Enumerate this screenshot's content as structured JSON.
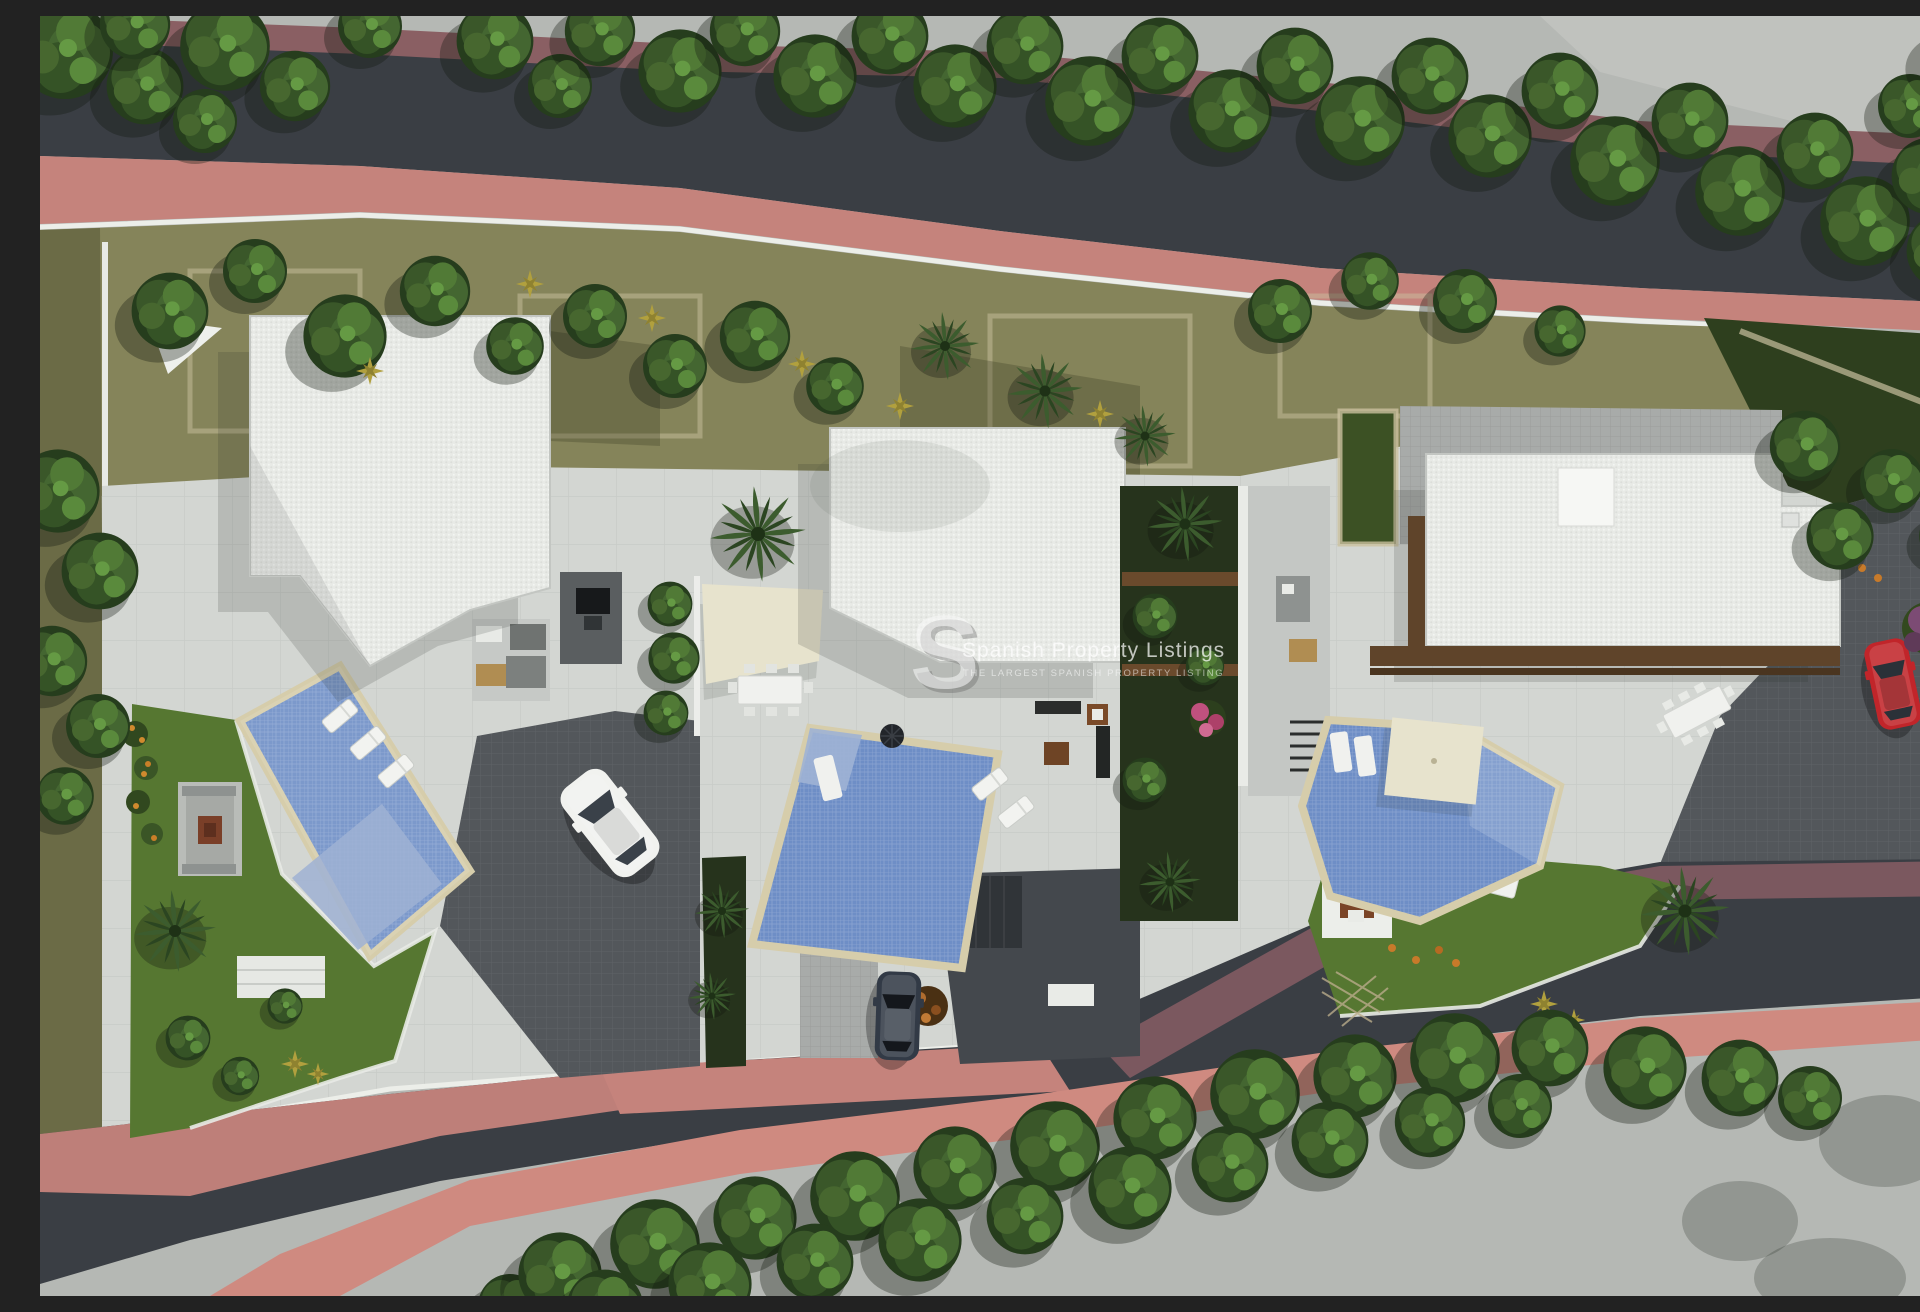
{
  "watermark": {
    "logo_letter": "S",
    "title": "Spanish Property Listings",
    "tagline": "THE LARGEST SPANISH PROPERTY LISTING"
  },
  "scene": {
    "type": "aerial-architectural-render",
    "description": "Top-down 3D visualisation of a hillside development plot with three modern villas, each with private pool, terraces, gardens and parking, wrapped by a curving dark asphalt road with terracotta-pink sidewalks lined with trees.",
    "villas": [
      {
        "name": "left-villa",
        "roof": "flat white gravel roof",
        "pool": "angled rectangular pool with end steps",
        "vehicles": [
          "white car on paver driveway"
        ],
        "features": [
          "three sun loungers",
          "outdoor sofa lounge",
          "sunken fire-pit lounge",
          "lawn with citrus shrubs",
          "corner shade sail"
        ]
      },
      {
        "name": "middle-villa",
        "roof": "flat white gravel roof",
        "pool": "skewed rectangular pool with swim-out lounger",
        "vehicles": [
          "dark saloon in drive"
        ],
        "features": [
          "cream shade sail",
          "outdoor dining table",
          "dark patio umbrella",
          "sun loungers",
          "palm garden strips",
          "lower dark courtyard"
        ]
      },
      {
        "name": "right-villa",
        "roof": "flat white roof with timber deck edge",
        "pool": "angular pool with in-water loungers",
        "vehicles": [
          "red car on side drive"
        ],
        "features": [
          "cream parasol",
          "long dining table",
          "fire-pit lounge on lawn",
          "paved entry courtyard",
          "planted corridor with stairs"
        ]
      }
    ],
    "environment": {
      "road": "dark asphalt loop",
      "sidewalks": "terracotta pink",
      "tree_rows": [
        "dense tree line along top road edge",
        "hedge row along lower road"
      ],
      "ground": "olive scrub terrace band above the plots"
    }
  },
  "palette": {
    "asphalt": "#3a3e44",
    "sidewalk_pink": "#c5837c",
    "sidewalk_mauve": "#7b585f",
    "curb_white": "#eceee9",
    "terrain_olive": "#85845a",
    "plot_paving": "#d3d6d2",
    "lawn_green": "#567731",
    "tree_dark": "#263d1d",
    "tree_light": "#5a8a3c",
    "pool_blue": "#6e8ec6",
    "pool_steps": "#9fb2d4",
    "roof_white": "#e8eae6",
    "timber_deck": "#5f442a",
    "shade_cream": "#e7e3cd",
    "car_white": "#f1f2ef",
    "car_dark": "#323a46",
    "car_red": "#c1252a"
  }
}
